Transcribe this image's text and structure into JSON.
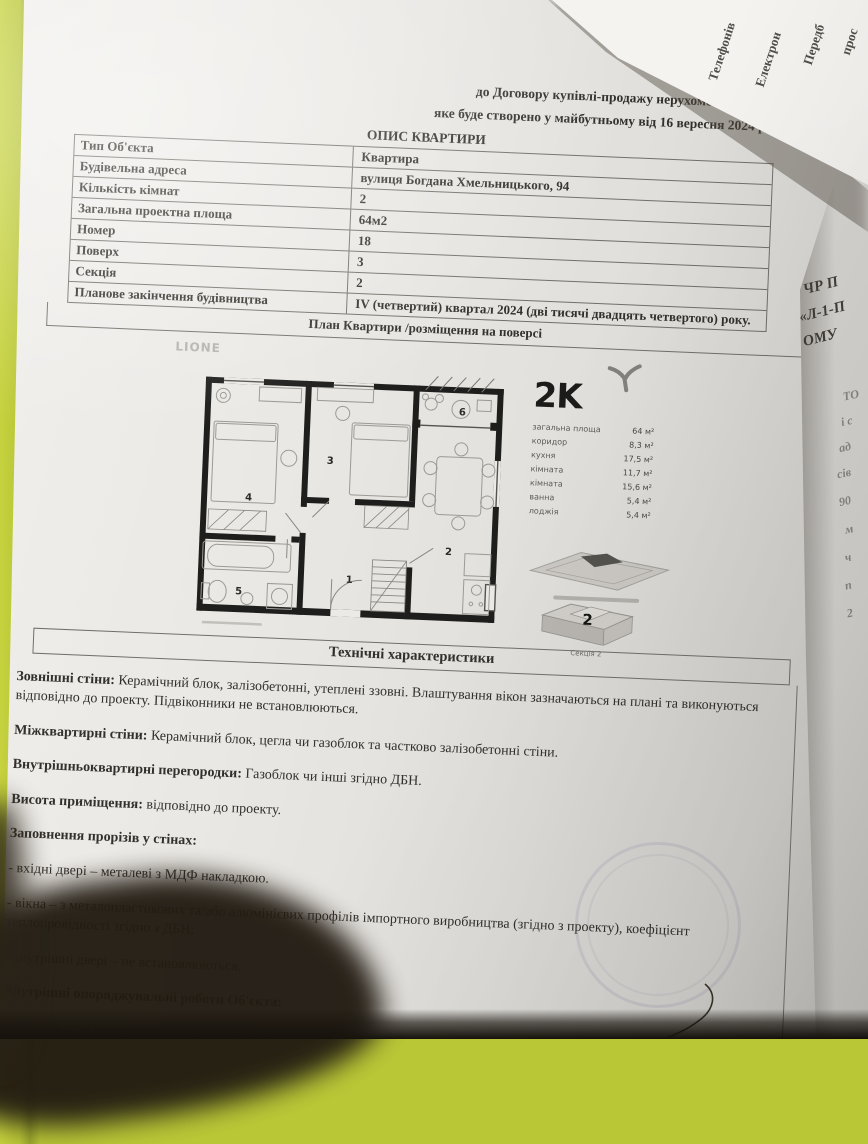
{
  "document": {
    "appendix_title": "Додаток №1",
    "contract_line": "до Договору купівлі-продажу нерухомого майна,",
    "date_line": "яке буде створено у майбутньому  від  16 вересня 2024 р.",
    "section_title": "ОПИС КВАРТИРИ",
    "table": {
      "rows": [
        {
          "label": "Тип Об'єкта",
          "value": "Квартира"
        },
        {
          "label": "Будівельна адреса",
          "value": "вулиця Богдана Хмельницького, 94"
        },
        {
          "label": "Кількість кімнат",
          "value": "2"
        },
        {
          "label": "Загальна проектна площа",
          "value": "64м2"
        },
        {
          "label": "Номер",
          "value": "18"
        },
        {
          "label": "Поверх",
          "value": "3"
        },
        {
          "label": "Секція",
          "value": "2"
        },
        {
          "label": "Планове закінчення будівництва",
          "value": "IV (четвертий) квартал 2024 (дві тисячі  двадцять четвертого) року."
        }
      ]
    },
    "plan": {
      "header": "План Квартири /розміщення на поверсі",
      "watermark": "LIONE",
      "apartment_code": "2K",
      "legend": [
        {
          "label": "загальна площа",
          "value": "64 м²"
        },
        {
          "label": "коридор",
          "value": "8,3 м²"
        },
        {
          "label": "кухня",
          "value": "17,5 м²"
        },
        {
          "label": "кімната",
          "value": "11,7 м²"
        },
        {
          "label": "кімната",
          "value": "15,6 м²"
        },
        {
          "label": "ванна",
          "value": "5,4 м²"
        },
        {
          "label": "лоджія",
          "value": "5,4 м²"
        }
      ],
      "room_numbers": [
        "1",
        "2",
        "3",
        "4",
        "5",
        "6"
      ],
      "section_badge": "2",
      "section_caption": "Секція 2"
    },
    "tech": {
      "header": "Технічні характеристики",
      "paragraphs": [
        {
          "label": "Зовнішні стіни:",
          "text": " Керамічний блок, залізобетонні, утеплені ззовні. Влаштування вікон зазначаються на плані та виконуються відповідно до проекту. Підвіконники не встановлюються."
        },
        {
          "label": "Міжквартирні стіни:",
          "text": " Керамічний блок, цегла чи газоблок та частково залізобетонні стіни."
        },
        {
          "label": "Внутрішньоквартирні перегородки:",
          "text": " Газоблок чи інші згідно ДБН."
        },
        {
          "label": "Висота приміщення:",
          "text": " відповідно до проекту."
        },
        {
          "label": "Заповнення прорізів у стінах:",
          "text": ""
        },
        {
          "label": "",
          "text": "- вхідні двері  – металеві з МДФ накладкою."
        },
        {
          "label": "",
          "text": "- вікна – з металопластикових та/або алюмінієвих профілів імпортного виробництва (згідно з проекту), коефіцієнт теплопровідності згідно з ДБН;"
        },
        {
          "label": "",
          "text": "- внутрішні двері – не встановлюються."
        },
        {
          "label": "Внутрішні опоряджувальні роботи Об'єкта:",
          "text": ""
        },
        {
          "label": "",
          "text": "- поверхні стін і перегородок – без опорядження;"
        }
      ]
    }
  },
  "edge_fragments": {
    "top_sheet_words": [
      "Телефонів",
      "Електрон",
      "Передб",
      "прос"
    ],
    "right_sheet_lines": [
      "ЧР П",
      "«Л-1-П",
      "ОМУ"
    ],
    "right_sheet_faint": [
      "ТО",
      "і с",
      "ад",
      "сів",
      "90",
      "м",
      "ч",
      "п",
      "2"
    ]
  },
  "colors": {
    "background_green": "#b9c636",
    "sticky_tab": "#cdd94f",
    "paper": "#eae8e4",
    "text": "#33302b",
    "plan_walls": "#1e1e1c"
  }
}
